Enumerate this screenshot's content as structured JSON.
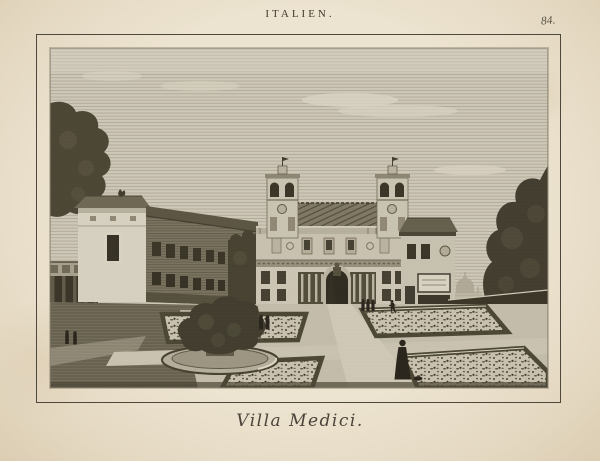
{
  "page": {
    "header": "ITALIEN.",
    "plate_number": "84.",
    "caption": "Villa Medici."
  },
  "colors": {
    "paper": "#ece3d0",
    "paper_edge": "#dbcdb2",
    "frame_ink": "#4e473b",
    "text_ink": "#42392e",
    "sky": "#cdc7b7",
    "foliage_dark": "#3b3628",
    "building_light": "#d7d1c1",
    "figure_ink": "#211d14"
  },
  "scene": {
    "subject": "Villa Medici",
    "elements": [
      "sky",
      "clouds",
      "left-tree",
      "garden-loggia",
      "corner-pavilion",
      "long-wing",
      "villa-facade",
      "left-belvedere-tower",
      "right-belvedere-tower",
      "entrance-arch",
      "right-pavilion",
      "distant-dome",
      "right-tree",
      "hedge-wall",
      "parterre-beds",
      "central-path",
      "cross-path",
      "fountain-with-shrub",
      "lawn",
      "figures"
    ]
  }
}
